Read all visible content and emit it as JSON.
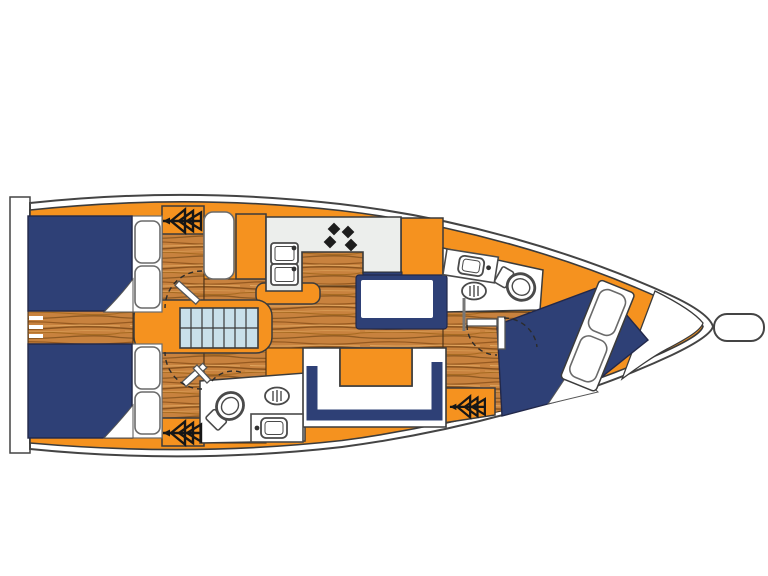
{
  "diagram": {
    "kind": "yacht-interior-floor-plan",
    "orientation": "bow-right",
    "areas": [
      "aft-port-cabin-berth",
      "aft-starboard-cabin-berth",
      "companionway-stairs",
      "galley",
      "chart-table",
      "saloon-u-settee",
      "saloon-table",
      "aft-head",
      "forward-head",
      "forward-cabin-berth",
      "bow-locker",
      "transom-platform"
    ],
    "fixtures": [
      "hatch-icon",
      "double-sink",
      "stove-burners",
      "toilet",
      "washbasin",
      "vent-grate",
      "pillows",
      "door-swing-arcs",
      "mast-post"
    ],
    "hatch_count": 3,
    "toilet_count": 2,
    "washbasin_count": 2,
    "berth_count": 3
  },
  "colors": {
    "deck_orange": "#F5921F",
    "upholstery_navy": "#2E4076",
    "wood_floor": "#C8823E",
    "wood_grain_dark": "#96591F",
    "counter_grey": "#ECEEEC",
    "stairs_blue": "#C9E0EA",
    "outline": "#3B3B3B",
    "white": "#FFFFFF",
    "burner_black": "#1D1D1D"
  }
}
